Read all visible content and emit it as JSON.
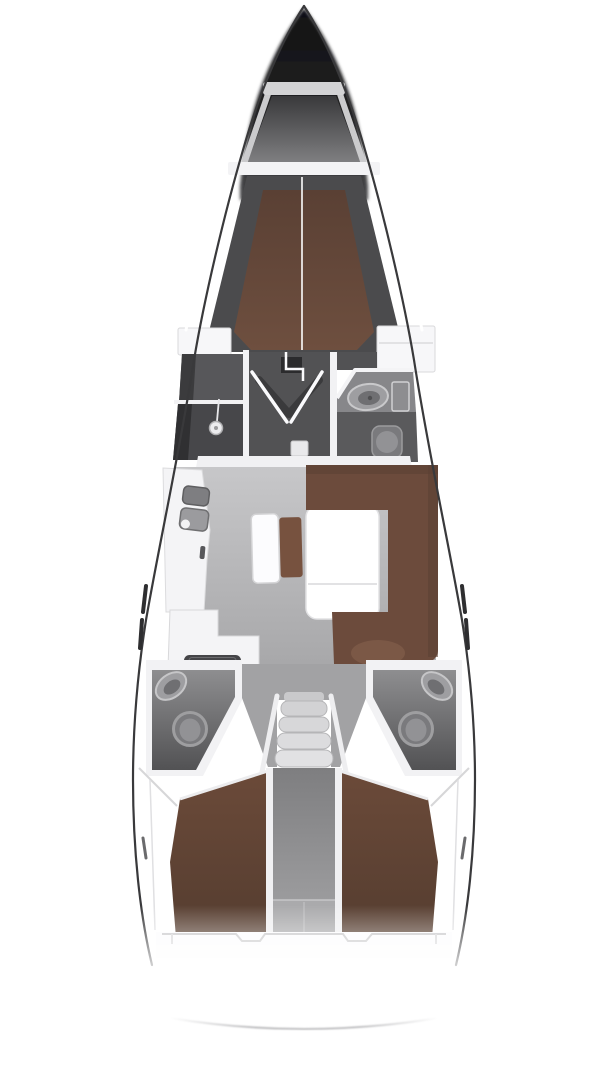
{
  "diagram": {
    "type": "yacht-interior-floor-plan",
    "view": "top-down",
    "orientation": "bow-up",
    "background": "#ffffff"
  },
  "rooms": [
    {
      "id": "anchor-locker"
    },
    {
      "id": "forward-v-berth-cabin"
    },
    {
      "id": "forward-shower-room"
    },
    {
      "id": "forward-head-with-sink-and-toilet"
    },
    {
      "id": "saloon"
    },
    {
      "id": "galley-port"
    },
    {
      "id": "navigation-seat"
    },
    {
      "id": "saloon-table"
    },
    {
      "id": "starboard-settee"
    },
    {
      "id": "port-aft-head"
    },
    {
      "id": "starboard-aft-head"
    },
    {
      "id": "companionway-steps"
    },
    {
      "id": "center-corridor"
    },
    {
      "id": "port-aft-cabin"
    },
    {
      "id": "starboard-aft-cabin"
    },
    {
      "id": "stern-transom"
    }
  ],
  "fixtures": [
    {
      "id": "shower-head"
    },
    {
      "id": "washbasin-forward"
    },
    {
      "id": "toilet-forward"
    },
    {
      "id": "galley-sink-1"
    },
    {
      "id": "galley-sink-2"
    },
    {
      "id": "galley-stove"
    },
    {
      "id": "washbasin-port-aft"
    },
    {
      "id": "toilet-port-aft"
    },
    {
      "id": "washbasin-starboard-aft"
    },
    {
      "id": "toilet-starboard-aft"
    }
  ],
  "colors": {
    "hull_line": "#39393b",
    "anchor_bar": "#d3d3d5",
    "anchor_wall": "#cbcbcd",
    "cross_band": "#f3f3f5",
    "shell": "#4b4b4d",
    "seam": "#fdfdfd",
    "wardrobe": "#f7f7f9",
    "wall_white": "#f2f2f4",
    "vestibule": "#525254",
    "door_slab": "#2b2b2d",
    "door_shadow": "#3a3a3c",
    "door_leaf": "#fafafc",
    "landing_pad": "#e9e9eb",
    "room_a": "#57575a",
    "room_a_dark": "#3b3b3d",
    "shower": "#47474a",
    "shower_dark": "#303032",
    "shower_head": "#ececee",
    "bath_counter": "#87878a",
    "bath_floor": "#5a5a5c",
    "sink_ring": "#9e9ea1",
    "sink_inner": "#6f6f72",
    "cabinet": "#8d8d90",
    "toilet_body": "#7a7a7d",
    "toilet_bowl": "#929295",
    "salon_band": "#f1f1f3",
    "galley_counter": "#f4f4f6",
    "sink1": "#7e7e81",
    "sink2": "#9b9b9e",
    "faucet": "#f2f2f4",
    "stove": "#454548",
    "bench": "#fcfcfe",
    "cushion": "#77523f",
    "table": "#ffffff",
    "table_edge": "#e2e2e4",
    "settee": "#6c4b3c",
    "settee_shade": "#5c4133",
    "settee_arm": "#7b5846",
    "head_shell": "#f2f2f4",
    "funnel_floor": "#a2a2a4",
    "fixture_ring_stroke": "#c6c6c8",
    "toilet_ring": "#9e9ea0",
    "steps": [
      "#d2d2d4",
      "#d7d7d9",
      "#dcdcde",
      "#e1e1e3"
    ],
    "step_top": "#c9c9cb",
    "rail": "#eeeef0",
    "corridor_wall": "#f0f0f2",
    "corridor_end": "#aaaaac",
    "transom": "#fcfcfd",
    "transom_line": "#c6c6c8",
    "slit_white": "#ffffff",
    "chainplate": "#2e2e30",
    "notch": "#6a6a6c",
    "deck_crease": "#d6d6d8",
    "stern_arc_mid": "#c2c2c4"
  }
}
